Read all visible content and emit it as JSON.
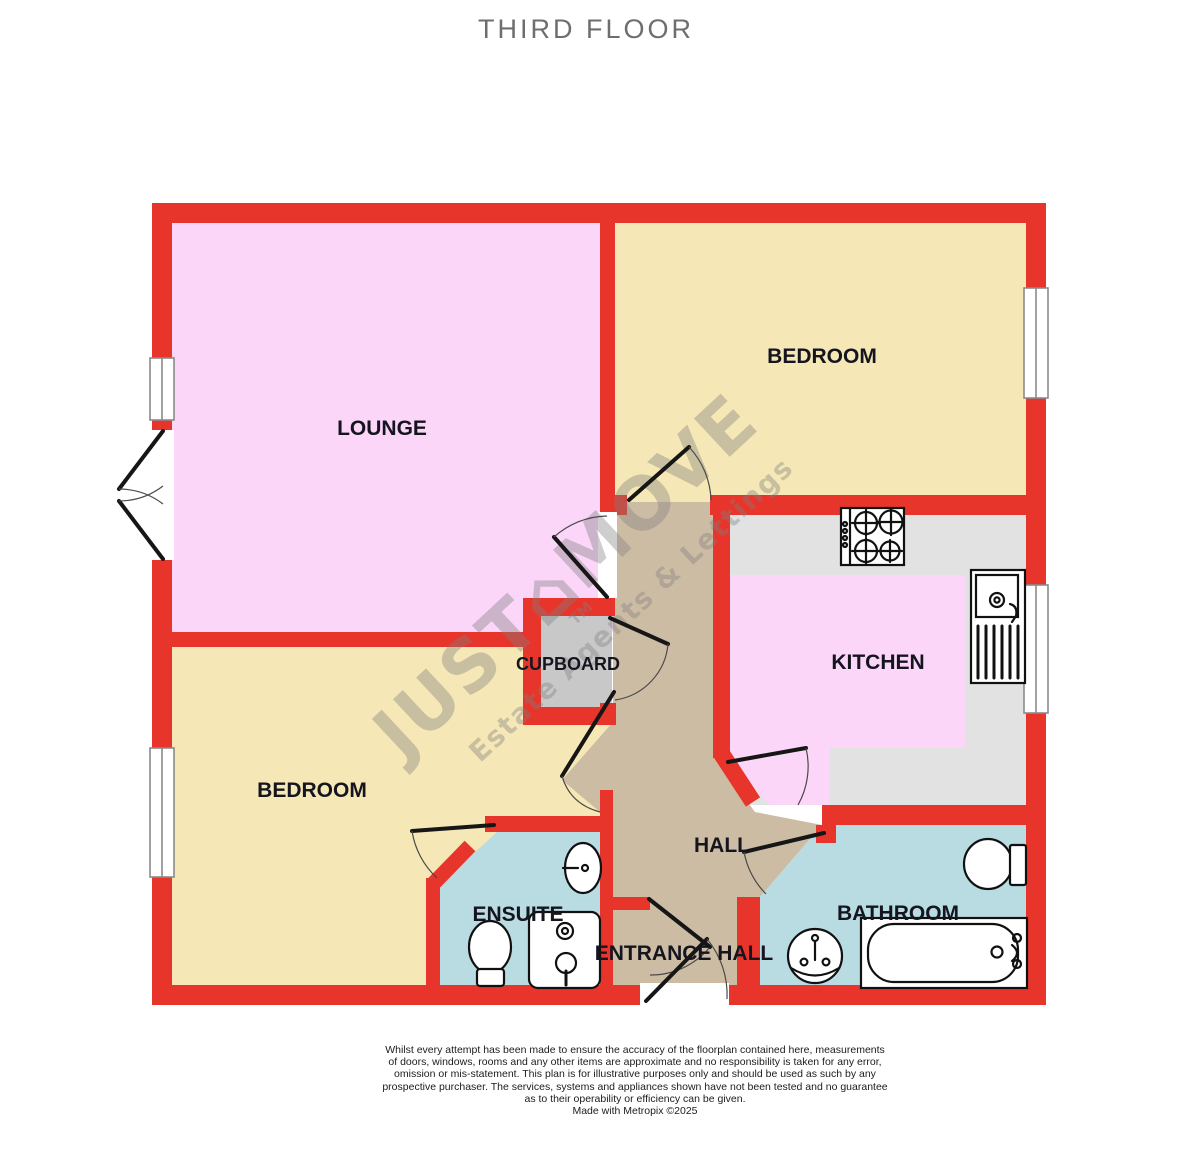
{
  "title": "THIRD FLOOR",
  "watermark": {
    "text": "JUST⌂MOVE",
    "tm": "TM",
    "tagline": "Estate Agents & Lettings"
  },
  "rooms": {
    "lounge": "LOUNGE",
    "bedroom_top": "BEDROOM",
    "kitchen": "KITCHEN",
    "cupboard": "CUPBOARD",
    "bedroom_bottom": "BEDROOM",
    "ensuite": "ENSUITE",
    "hall": "HALL",
    "entrance_hall": "ENTRANCE HALL",
    "bathroom": "BATHROOM"
  },
  "disclaimer": {
    "lines": [
      "Whilst every attempt has been made to ensure the accuracy of the floorplan contained here, measurements",
      "of doors, windows, rooms and any other items are approximate and no responsibility is taken for any error,",
      "omission or mis-statement. This plan is for illustrative purposes only and should be used as such by any",
      "prospective purchaser. The services, systems and appliances shown have not been tested and no guarantee",
      "as to their operability or efficiency can be given.",
      "Made with Metropix ©2025"
    ]
  },
  "colors": {
    "wall_red": "#e8352c",
    "room_pink": "#fbd6f9",
    "room_cream": "#f6e8b6",
    "hall_tan": "#cdbca4",
    "bath_blue": "#b9dbe2",
    "kitchen_grey": "#e2e2e2",
    "cupboard_grey": "#c8c8c8",
    "label_ink": "#15151f",
    "title_grey": "#6e6e6e",
    "watermark_grey": "#7f7f7f",
    "fixture_ink": "#111111"
  }
}
